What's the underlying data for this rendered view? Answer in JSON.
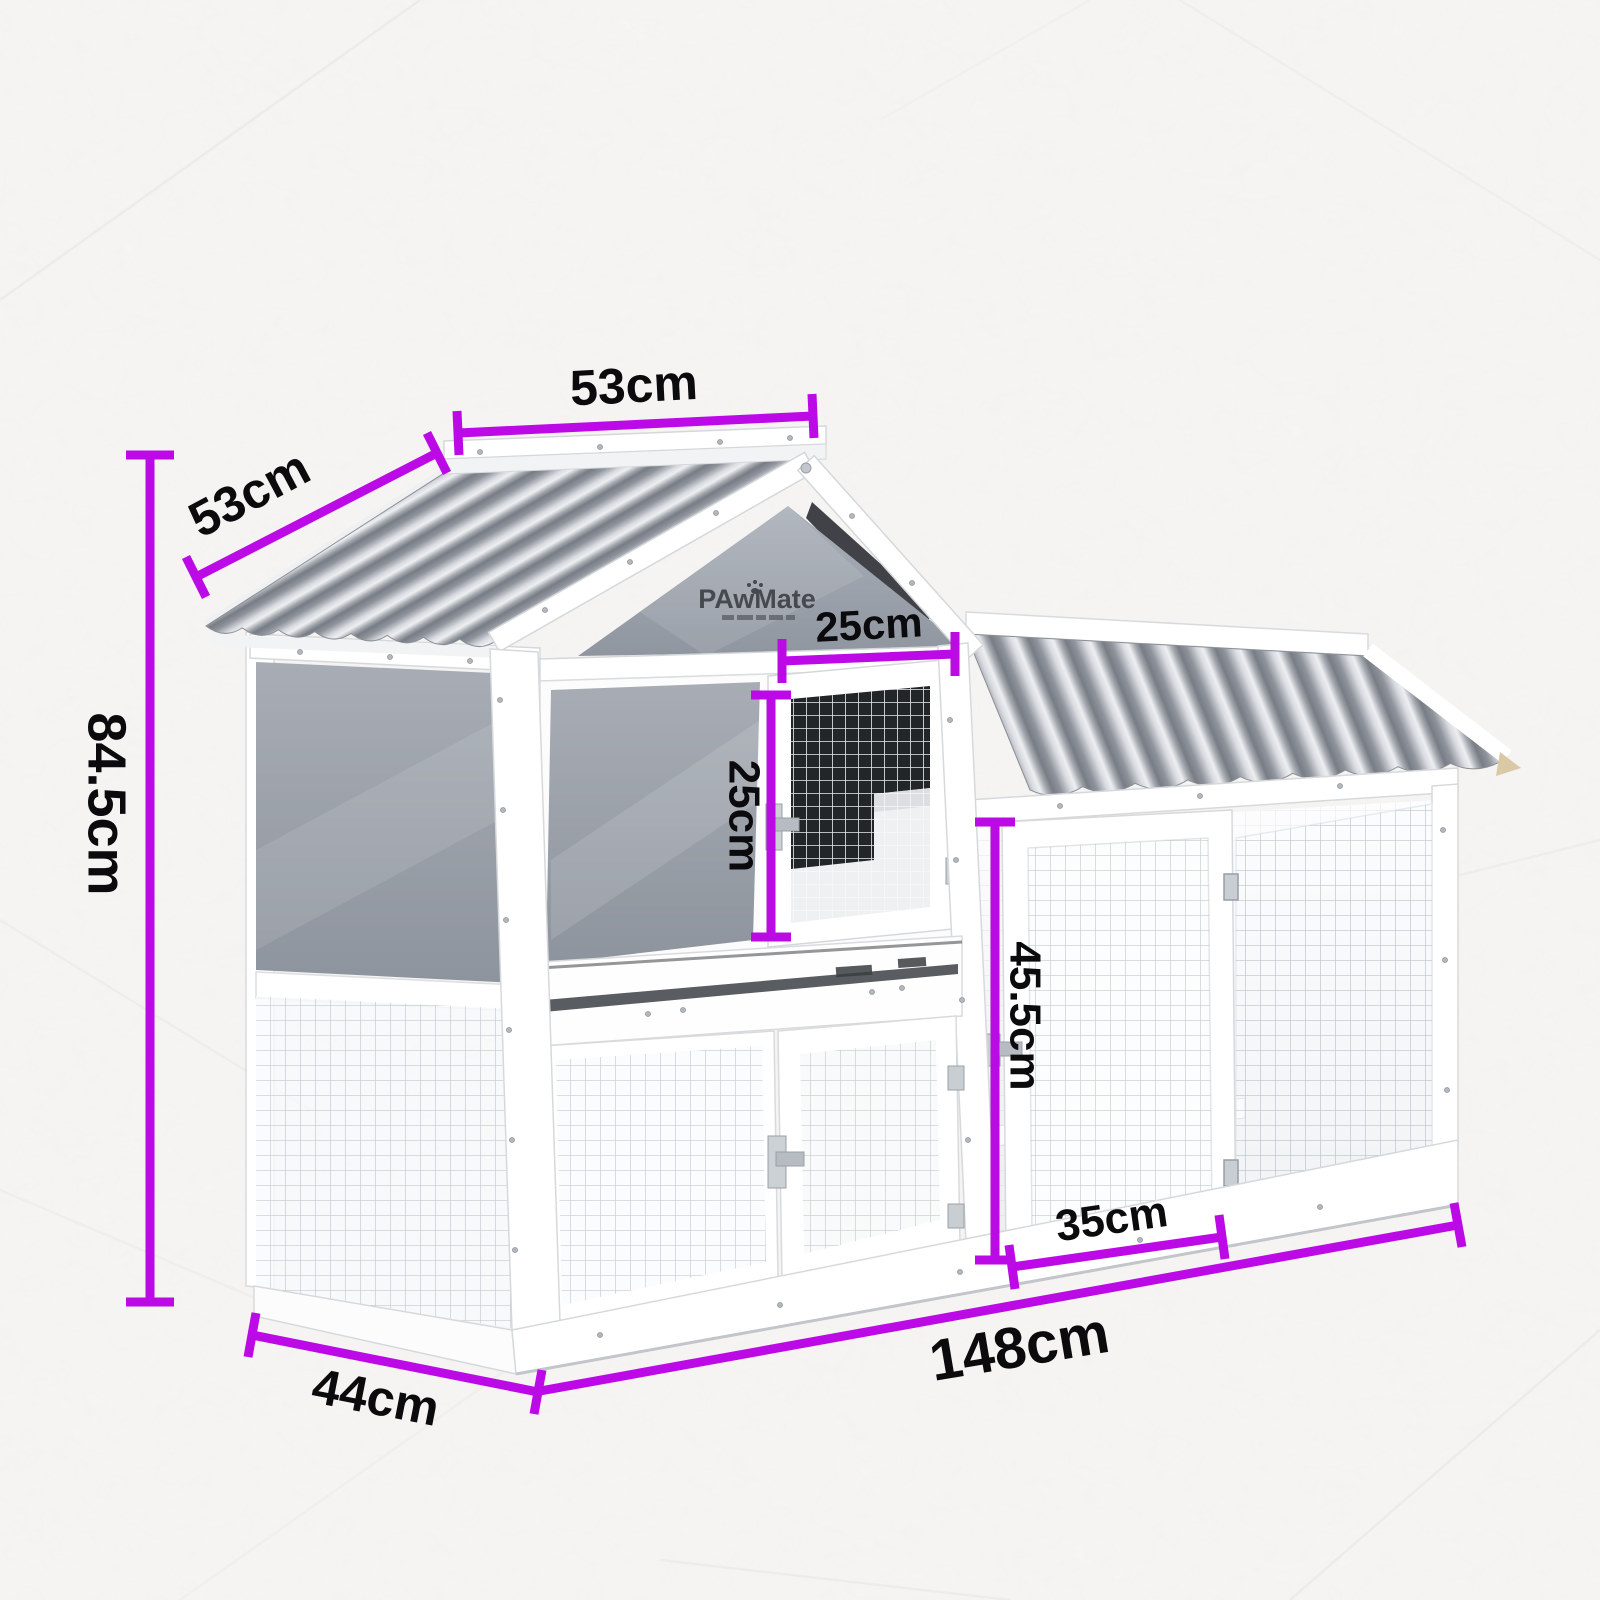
{
  "title": "Dimensions",
  "subtitle": "148cm(L) x 44cm(W) x 84.5cm(H)",
  "brand": {
    "logo": "PAwMate"
  },
  "dims": {
    "total_height": "84.5cm",
    "roof_panel_width": "53cm",
    "roof_panel_depth": "53cm",
    "hutch_door_width": "25cm",
    "hutch_door_height": "25cm",
    "run_height": "45.5cm",
    "run_door_width": "35cm",
    "total_length": "148cm",
    "total_depth": "44cm"
  },
  "colors": {
    "accent": "#BC0AE6",
    "roof_grey": "#9aa0a9",
    "text": "#0b0b0d"
  }
}
